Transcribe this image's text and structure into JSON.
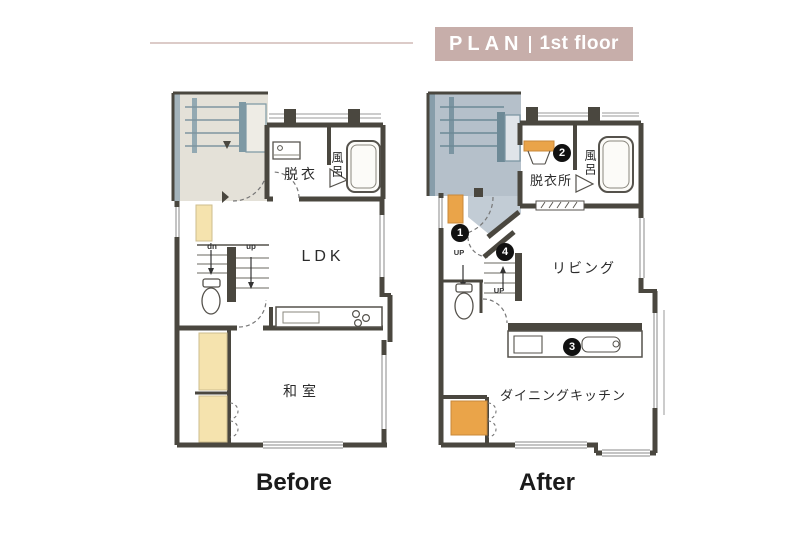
{
  "header": {
    "title": "PLAN",
    "subtitle": "1st floor",
    "bg_color": "#c7aeaa",
    "text_color": "#ffffff"
  },
  "plans": {
    "before": {
      "caption": "Before",
      "rooms": {
        "dressing": "脱衣",
        "bath": "風呂",
        "ldk": "LDK",
        "japanese_room": "和室"
      },
      "stairs": {
        "down": "dn",
        "up": "up"
      }
    },
    "after": {
      "caption": "After",
      "rooms": {
        "dressing": "脱衣所",
        "bath": "風呂",
        "living": "リビング",
        "dining_kitchen": "ダイニングキッチン"
      },
      "stairs": {
        "up1": "UP",
        "up2": "UP"
      },
      "markers": [
        {
          "label": "1"
        },
        {
          "label": "2"
        },
        {
          "label": "3"
        },
        {
          "label": "4"
        }
      ]
    }
  },
  "colors": {
    "wall": "#4a473f",
    "entrance_before": "#e4e1d8",
    "entrance_after": "#b5c0ca",
    "accent_teal": "#7e99a4",
    "closet_yellow": "#f5e3ae",
    "highlight_orange": "#eaa449",
    "header_bg": "#c7aeaa",
    "divider_line": "#dccbc8"
  }
}
